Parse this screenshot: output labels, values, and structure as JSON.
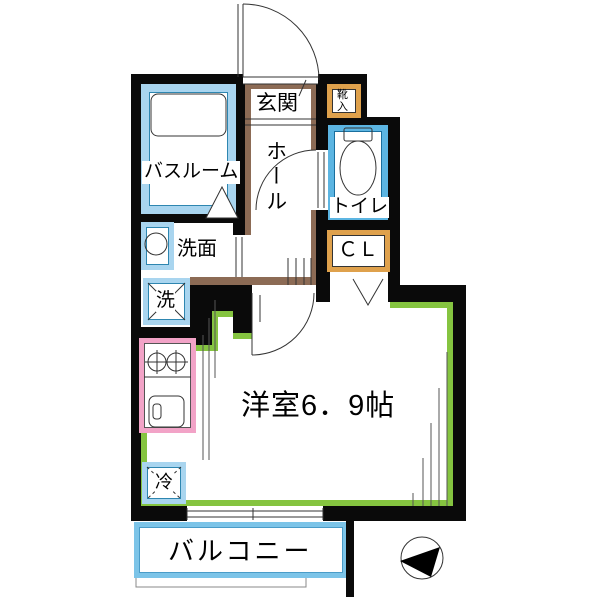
{
  "plan": {
    "title": "1K apartment floor plan",
    "rooms": {
      "genkan": "玄関",
      "shoe_box": "靴入",
      "hall": "ホール",
      "toilet": "トイレ",
      "bathroom": "バスルーム",
      "washbasin": "洗面",
      "washer": "洗",
      "closet": "ＣＬ",
      "main_room": "洋室6．9帖",
      "fridge": "冷",
      "balcony": "バルコニー"
    },
    "colors": {
      "wall": "#0a0a0a",
      "water_blue": "#A9D5EF",
      "toilet_blue": "#5CB5E2",
      "balcony_blue": "#7CC4E8",
      "storage_orange": "#DFA14C",
      "kitchen_pink": "#F2A3C7",
      "room_green": "#85C440",
      "hall_brown": "#8C6B55"
    },
    "icons": [
      "entrance-door-arc",
      "room-door-arc",
      "toilet-door-arc",
      "bathtub",
      "toilet-fixture",
      "wash-basin-circle",
      "stove-burners",
      "kitchen-sink",
      "washer-cross",
      "fridge-cross",
      "closet-door-v",
      "bath-door-triangle",
      "loft-ladder-lines",
      "sliding-window",
      "compass-north-arrow"
    ]
  }
}
